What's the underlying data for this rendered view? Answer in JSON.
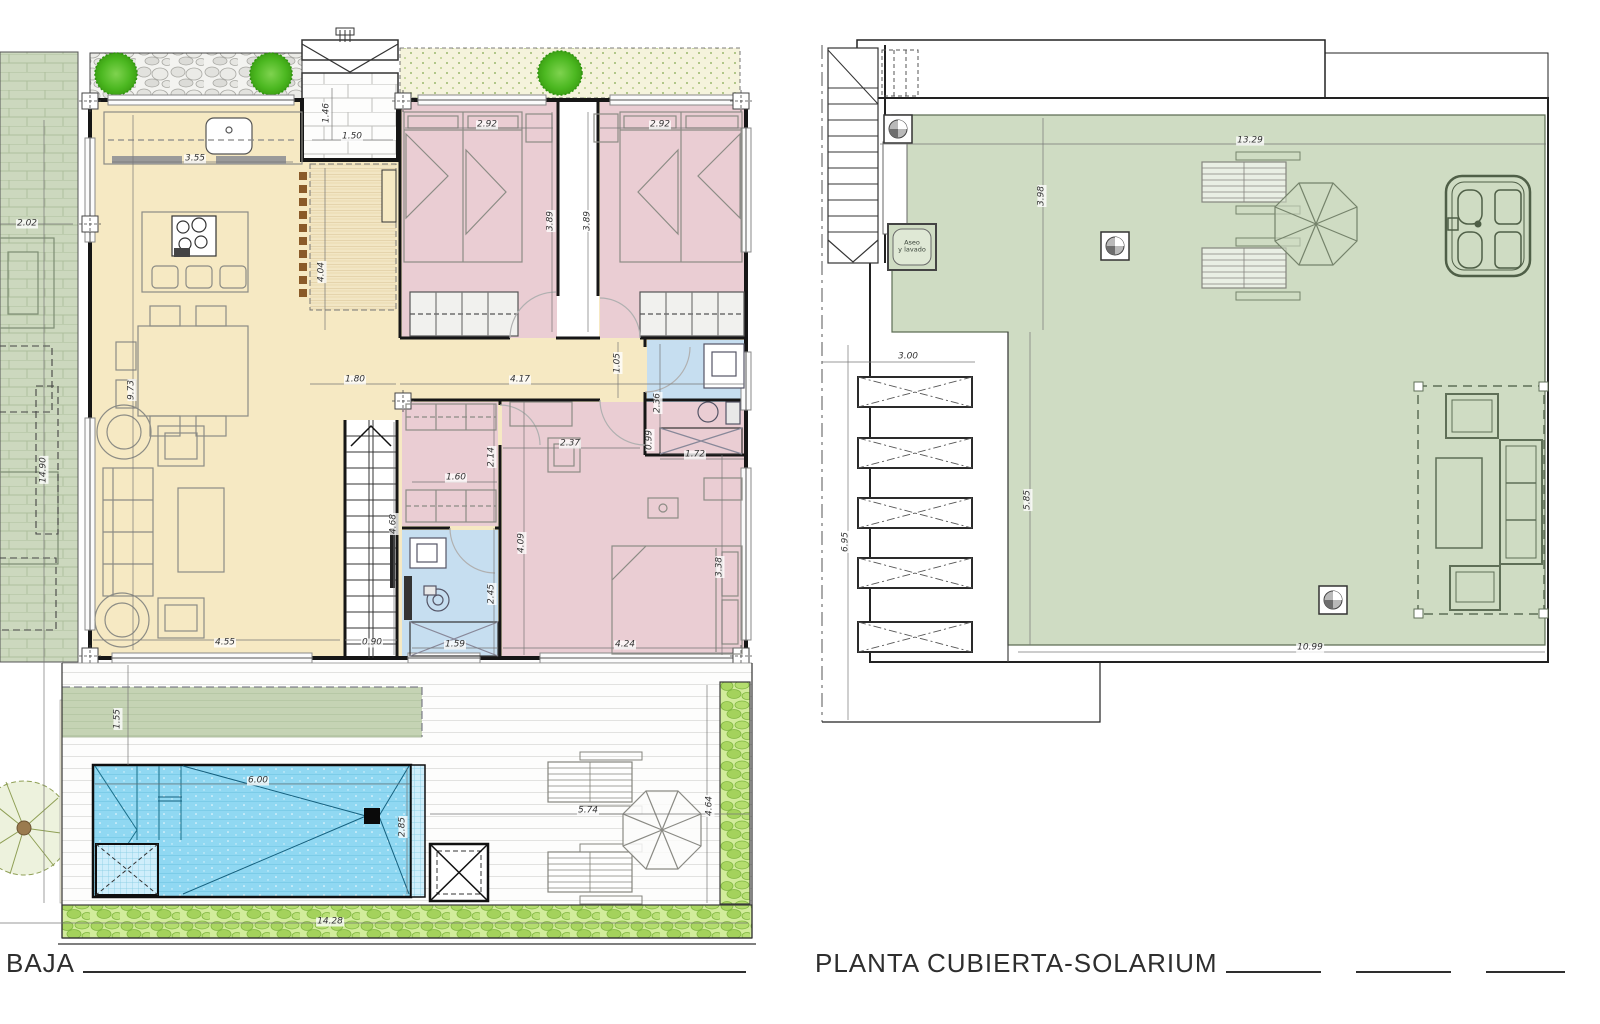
{
  "document": {
    "type": "architectural floor plan sheet",
    "background": "#ffffff"
  },
  "colors": {
    "wall": "#161616",
    "room_yellow": "#f6e9c3",
    "room_pink": "#eacdd3",
    "room_blue": "#c6def0",
    "terrace_sage": "#ccd8be",
    "solarium_green": "#cfdcc3",
    "pool_blue": "#90d8f2",
    "tree_green": "#4cb821",
    "grass_gravel": "#d2ec9b",
    "dim_text": "#333333"
  },
  "left_plan": {
    "title": "BAJA",
    "dimensions": [
      {
        "text": "2.02",
        "x": 27,
        "y": 224
      },
      {
        "text": "14.90",
        "x": 44,
        "y": 470,
        "v": true
      },
      {
        "text": "3.55",
        "x": 195,
        "y": 159
      },
      {
        "text": "1.46",
        "x": 327,
        "y": 113,
        "v": true
      },
      {
        "text": "1.50",
        "x": 352,
        "y": 137
      },
      {
        "text": "4.04",
        "x": 322,
        "y": 272,
        "v": true
      },
      {
        "text": "2.92",
        "x": 487,
        "y": 125
      },
      {
        "text": "2.92",
        "x": 660,
        "y": 125
      },
      {
        "text": "3.89",
        "x": 551,
        "y": 221,
        "v": true
      },
      {
        "text": "3.89",
        "x": 588,
        "y": 221,
        "v": true
      },
      {
        "text": "9.73",
        "x": 132,
        "y": 390,
        "v": true
      },
      {
        "text": "1.80",
        "x": 355,
        "y": 380
      },
      {
        "text": "4.17",
        "x": 520,
        "y": 380
      },
      {
        "text": "1.05",
        "x": 618,
        "y": 363,
        "v": true
      },
      {
        "text": "2.36",
        "x": 658,
        "y": 403,
        "v": true
      },
      {
        "text": "2.37",
        "x": 570,
        "y": 444
      },
      {
        "text": "1.72",
        "x": 695,
        "y": 455
      },
      {
        "text": "0.99",
        "x": 650,
        "y": 440,
        "v": true
      },
      {
        "text": "1.60",
        "x": 456,
        "y": 478
      },
      {
        "text": "2.14",
        "x": 492,
        "y": 457,
        "v": true
      },
      {
        "text": "4.09",
        "x": 522,
        "y": 543,
        "v": true
      },
      {
        "text": "3.38",
        "x": 720,
        "y": 567,
        "v": true
      },
      {
        "text": "2.45",
        "x": 492,
        "y": 594,
        "v": true
      },
      {
        "text": "4.68",
        "x": 394,
        "y": 524,
        "v": true
      },
      {
        "text": "0.90",
        "x": 372,
        "y": 643
      },
      {
        "text": "4.55",
        "x": 225,
        "y": 643
      },
      {
        "text": "1.59",
        "x": 455,
        "y": 645
      },
      {
        "text": "4.24",
        "x": 625,
        "y": 645
      },
      {
        "text": "1.55",
        "x": 118,
        "y": 719,
        "v": true
      },
      {
        "text": "6.00",
        "x": 258,
        "y": 781
      },
      {
        "text": "2.85",
        "x": 403,
        "y": 827,
        "v": true
      },
      {
        "text": "5.74",
        "x": 588,
        "y": 811
      },
      {
        "text": "4.64",
        "x": 710,
        "y": 806,
        "v": true
      },
      {
        "text": "14.28",
        "x": 330,
        "y": 922
      }
    ]
  },
  "right_plan": {
    "title": "PLANTA CUBIERTA-SOLARIUM",
    "dimensions": [
      {
        "text": "13.29",
        "x": 1250,
        "y": 141
      },
      {
        "text": "3.98",
        "x": 1042,
        "y": 196,
        "v": true
      },
      {
        "text": "3.00",
        "x": 908,
        "y": 357
      },
      {
        "text": "6.95",
        "x": 846,
        "y": 542,
        "v": true
      },
      {
        "text": "5.85",
        "x": 1028,
        "y": 500,
        "v": true
      },
      {
        "text": "10.99",
        "x": 1310,
        "y": 648
      }
    ],
    "annotations": [
      {
        "text": "Aseo\ny lavado",
        "x": 912,
        "y": 247
      }
    ]
  }
}
